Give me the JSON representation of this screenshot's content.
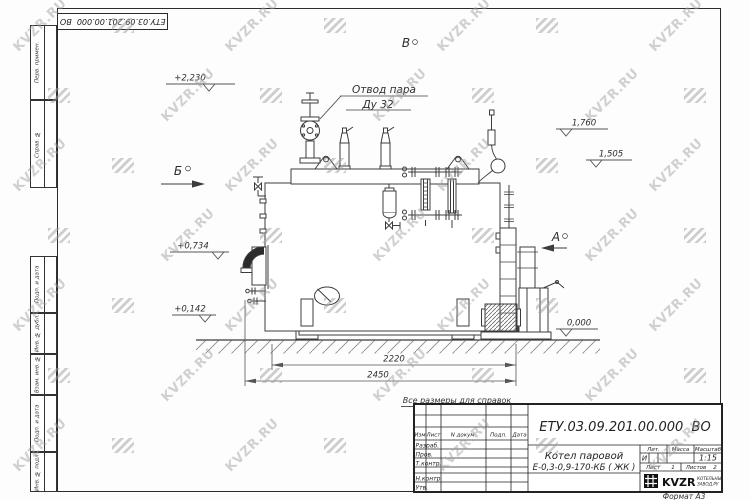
{
  "sheet": {
    "top_stamp_designation": "ЕТУ.03.09.201.00.000  ВО",
    "reference_note": "Все размеры для справок",
    "format_note": "Формат А3"
  },
  "margin_columns": {
    "top": [
      "Перв. примен.",
      "Справ. №"
    ],
    "bottom": [
      "Подп. и дата",
      "Инв. № дубл.",
      "Взам. инв. №",
      "Подп. и дата",
      "Инв. № подл."
    ]
  },
  "drawing": {
    "callout": {
      "line1": "Отвод пара",
      "line2": "Ду 32"
    },
    "view_markers": {
      "a": "А",
      "b": "Б",
      "v": "В"
    },
    "elevations": {
      "e2230": "+2,230",
      "e1760": "1,760",
      "e1505": "1,505",
      "e0734": "+0,734",
      "e0142": "+0,142",
      "e0000": "0,000"
    },
    "dimensions": {
      "d2220": "2220",
      "d2450": "2450"
    }
  },
  "title_block": {
    "designation": "ЕТУ.03.09.201.00.000  ВО",
    "product_name_line1": "Котел паровой",
    "product_name_line2": "Е-0,3-0,9-170-КБ ( ЖК )",
    "columns": {
      "izm": "Изм",
      "list": "Лист",
      "doc": "N докум.",
      "podp": "Подп.",
      "data": "Дата"
    },
    "rows": {
      "razrab": "Разраб.",
      "prov": "Пров.",
      "tkontr": "Т.контр.",
      "nkontr": "Н.контр.",
      "utv": "Утв."
    },
    "lit_label": "Лит.",
    "lit_value": "И",
    "mass_label": "Масса",
    "scale_label": "Масштаб",
    "scale_value": "1:15",
    "sheet_label": "Лист",
    "sheet_value": "1",
    "sheets_label": "Листов",
    "sheets_value": "2",
    "company_name": "KVZR",
    "company_line1": "КОТЕЛЬНЫЙ",
    "company_line2": "ЗАВОД.РУ"
  },
  "watermark": {
    "text": "KVZR.RU"
  }
}
